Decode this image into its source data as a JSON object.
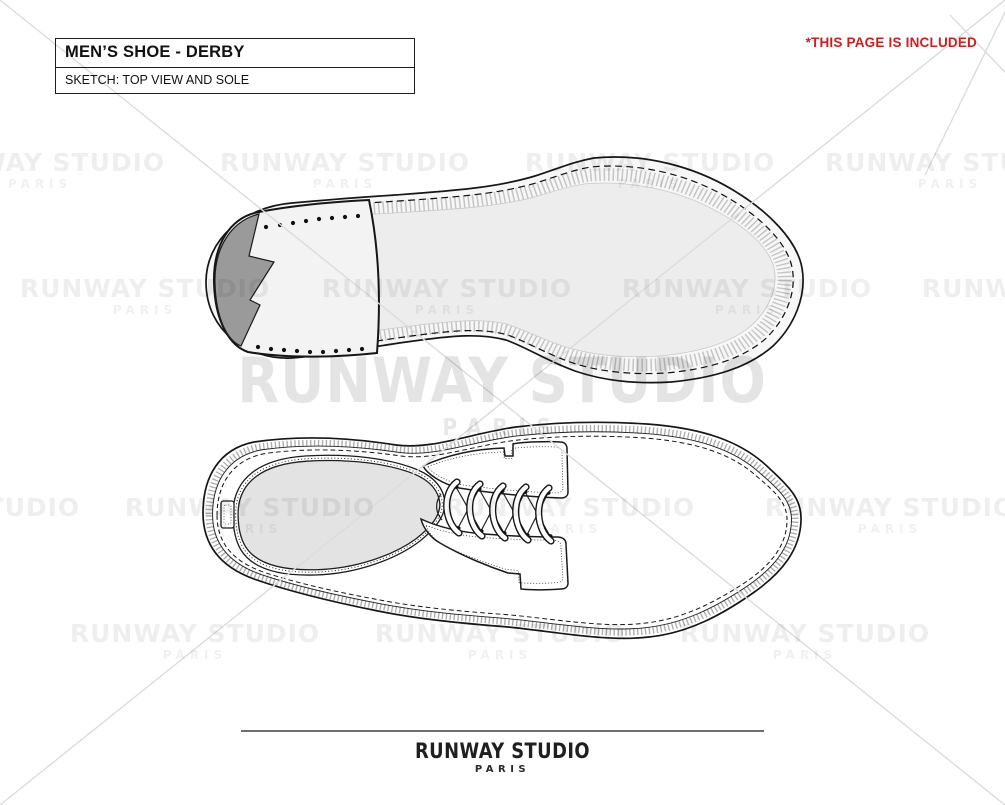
{
  "header": {
    "title": "MEN’S SHOE - DERBY",
    "subtitle": "SKETCH: TOP VIEW AND SOLE"
  },
  "notice": {
    "text": "*THIS PAGE IS INCLUDED"
  },
  "watermark": {
    "line1": "RUNWAY STUDIO",
    "line2": "PARIS"
  },
  "footer": {
    "brand": "RUNWAY STUDIO",
    "city": "PARIS"
  },
  "colors": {
    "notice_red": "#cf1d1d",
    "line_black": "#1a1a1a",
    "sole_fill": "#f7f7f7",
    "sole_inner": "#ededed",
    "heel_fill": "#f3f3f3",
    "heel_toppiece_gray": "#9a9a9a",
    "insole_gray": "#e3e3e3",
    "watermark_gray": "#e9e9e9",
    "footer_rule_gray": "#6e6e6e"
  }
}
